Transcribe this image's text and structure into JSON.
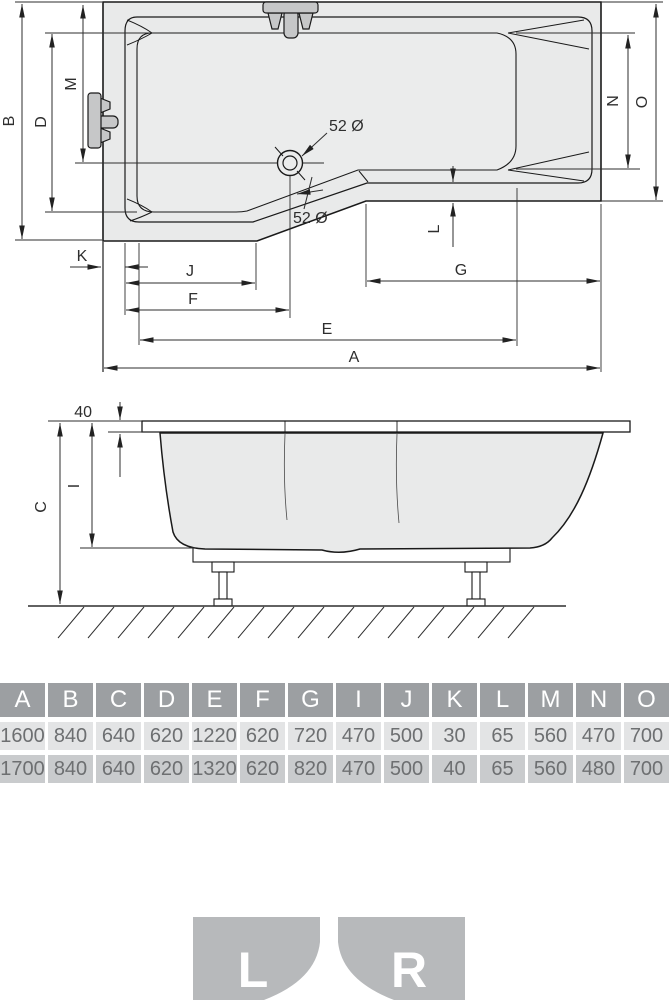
{
  "drawing": {
    "top_view": {
      "dims": {
        "A": "A",
        "B": "B",
        "D": "D",
        "E": "E",
        "F": "F",
        "G": "G",
        "J": "J",
        "K": "K",
        "L": "L",
        "M": "M",
        "N": "N",
        "O": "O"
      },
      "drain_label": "52 Ø",
      "overflow_label": "52 Ø"
    },
    "side_view": {
      "dims": {
        "C": "C",
        "I": "I"
      },
      "rim_thickness": "40"
    }
  },
  "table": {
    "headers": [
      "A",
      "B",
      "C",
      "D",
      "E",
      "F",
      "G",
      "I",
      "J",
      "K",
      "L",
      "M",
      "N",
      "O"
    ],
    "rows": [
      [
        "1600",
        "840",
        "640",
        "620",
        "1220",
        "620",
        "720",
        "470",
        "500",
        "30",
        "65",
        "560",
        "470",
        "700"
      ],
      [
        "1700",
        "840",
        "640",
        "620",
        "1320",
        "620",
        "820",
        "470",
        "500",
        "40",
        "65",
        "560",
        "480",
        "700"
      ]
    ]
  },
  "orientation": {
    "left": "L",
    "right": "R"
  },
  "colors": {
    "deck_fill": "#e9eaea",
    "basin_fill": "#ebecec",
    "fixture_fill": "#c6c7c8",
    "line": "#1a1a1a",
    "dim_line": "#2e2e2e",
    "table_header_bg": "#9c9fa2",
    "table_row1_bg": "#e3e4e5",
    "table_row2_bg": "#c9cbcd",
    "table_text": "#6d6f71",
    "variant_bg": "#b7b9bb"
  }
}
